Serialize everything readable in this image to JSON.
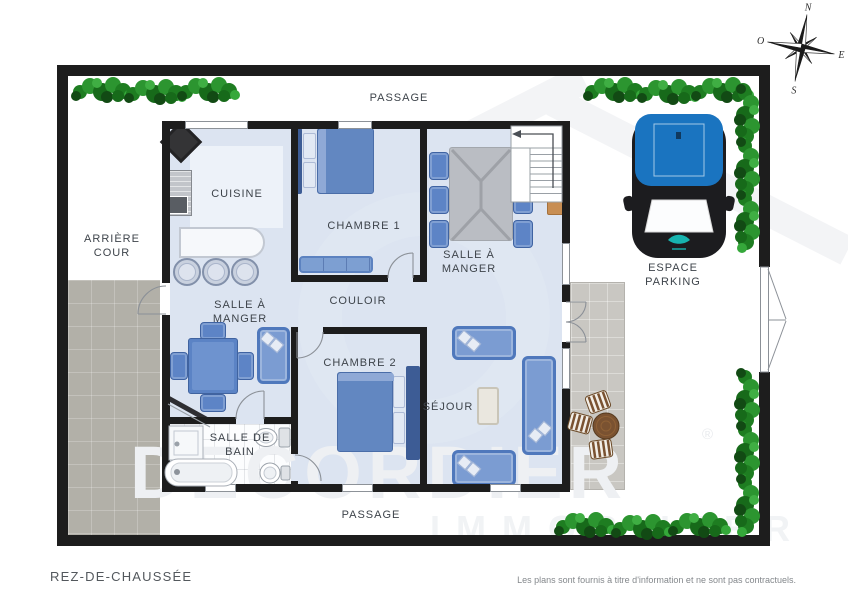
{
  "meta": {
    "floor_title": "REZ-DE-CHAUSSÉE",
    "disclaimer": "Les plans sont fournis à titre d'information et ne sont pas contractuels."
  },
  "watermark": {
    "brand": "DECORDIER",
    "suffix": "IMMOBILIER",
    "registered": "®"
  },
  "compass": {
    "north": "N",
    "west": "O",
    "east": "E",
    "south": "S"
  },
  "labels": {
    "passage_top": "PASSAGE",
    "passage_bottom": "PASSAGE",
    "arriere_cour": "ARRIÈRE COUR",
    "cuisine": "CUISINE",
    "chambre1": "CHAMBRE 1",
    "salle_a_manger_haut": "SALLE À MANGER",
    "salle_a_manger_bas": "SALLE À MANGER",
    "couloir": "COULOIR",
    "chambre2": "CHAMBRE 2",
    "sejour": "SÉJOUR",
    "salle_de_bain": "SALLE DE BAIN",
    "espace_parking": "ESPACE PARKING"
  },
  "colors": {
    "wall": "#1d1d1d",
    "floor": "#dce4f1",
    "floor-light": "#edf2f9",
    "furn": "#6287c1",
    "furn-dark": "#4f78bc",
    "hedge": "#2f9a2f",
    "car": "#1a74c0",
    "patio": "#b2b0a8",
    "terrace": "#c9c7c2",
    "label": "#3e444b",
    "wm": "#eef0f3"
  }
}
